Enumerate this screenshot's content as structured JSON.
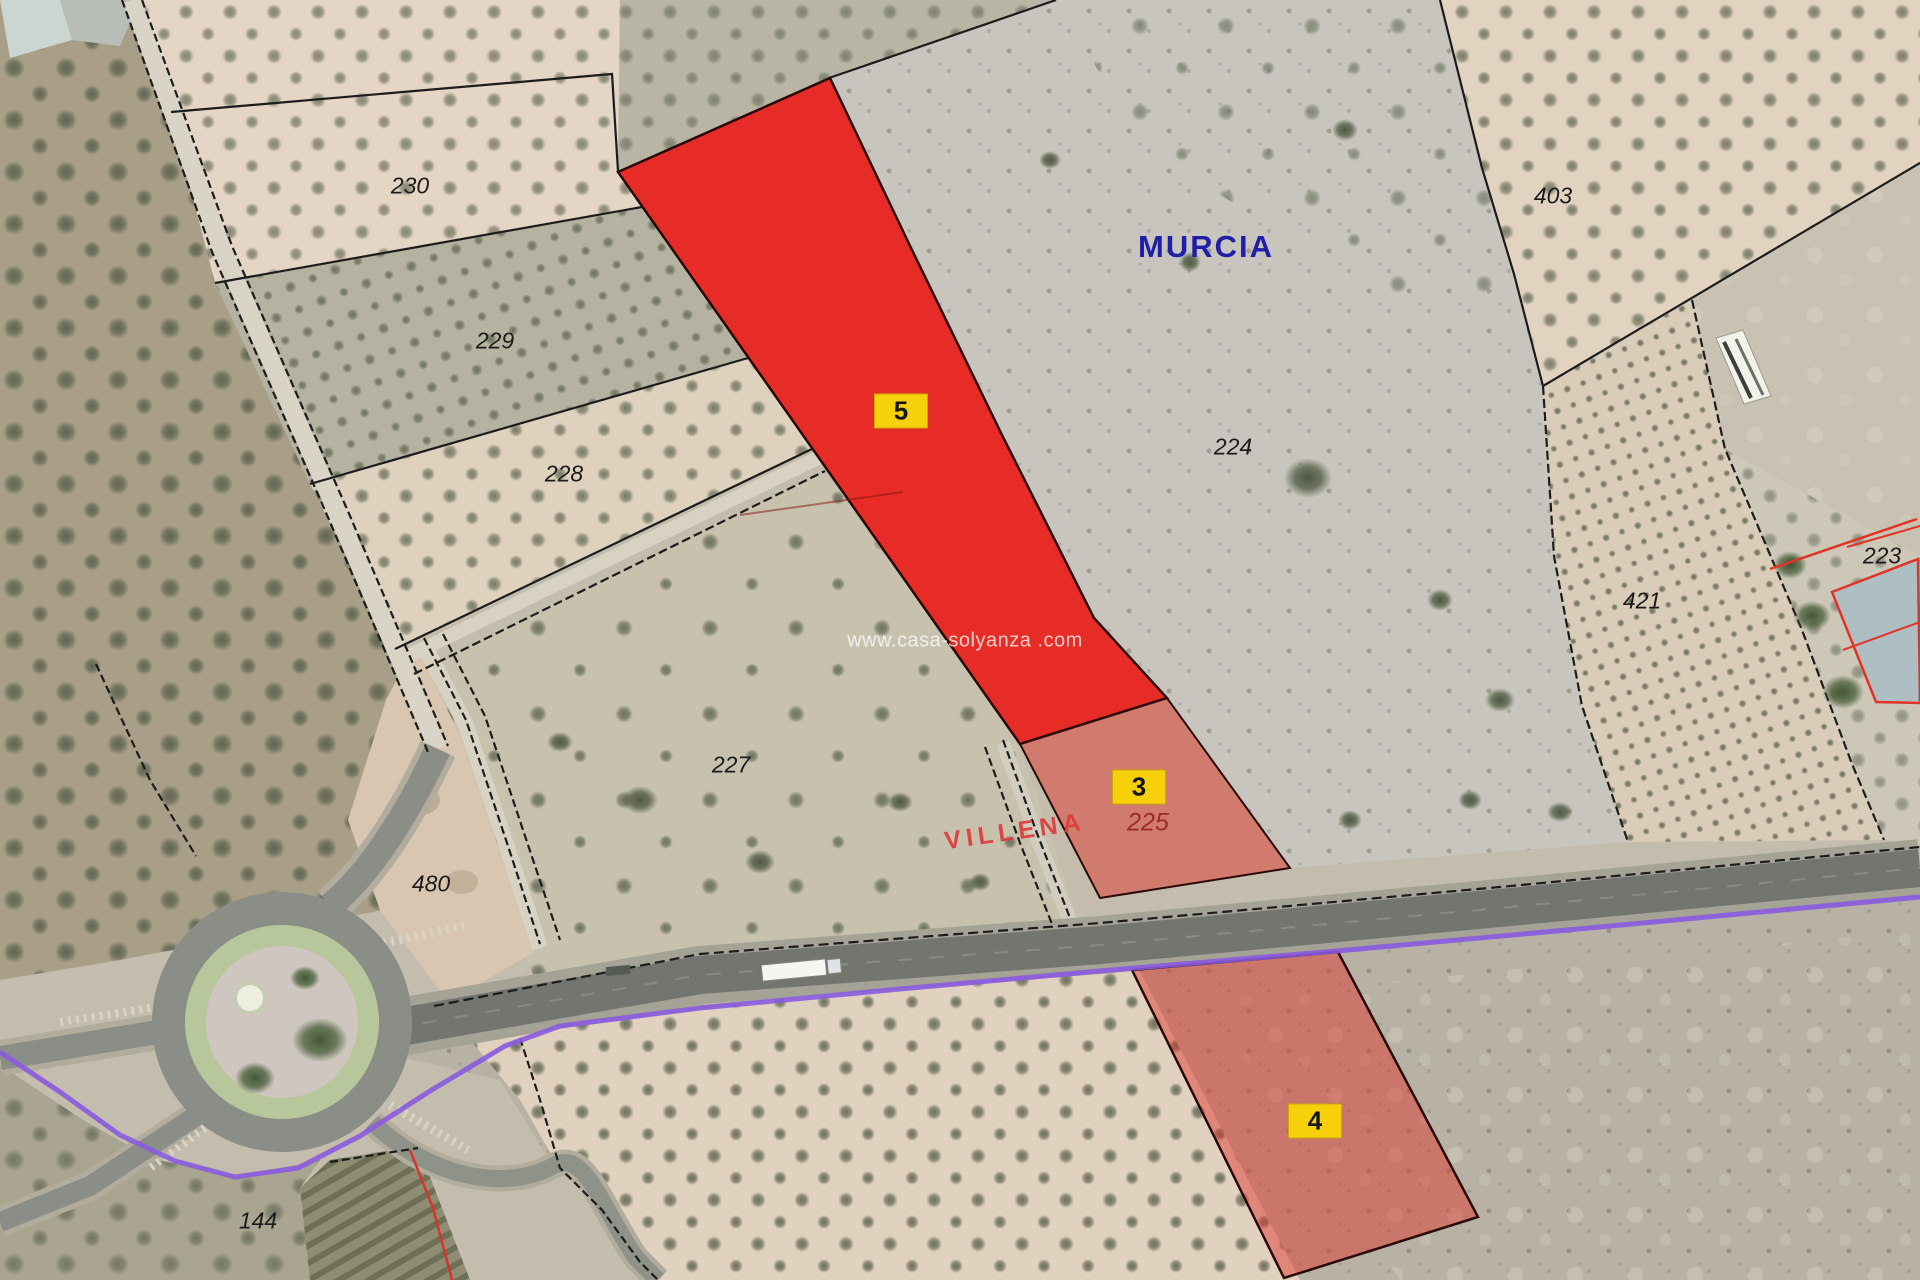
{
  "map": {
    "watermark": "www.casa-solyanza .com",
    "municipality_labels": [
      {
        "text": "MURCIA",
        "color": "#1f1fa8"
      },
      {
        "text": "VILLENA",
        "color": "#dc3c3c"
      }
    ],
    "parcel_numbers": [
      {
        "text": "230"
      },
      {
        "text": "229"
      },
      {
        "text": "228"
      },
      {
        "text": "227"
      },
      {
        "text": "480"
      },
      {
        "text": "144"
      },
      {
        "text": "224"
      },
      {
        "text": "403"
      },
      {
        "text": "421"
      },
      {
        "text": "223"
      },
      {
        "text": "225"
      }
    ],
    "plot_badges": [
      {
        "text": "5"
      },
      {
        "text": "3"
      },
      {
        "text": "4"
      }
    ],
    "colors": {
      "highlight_solid": "#e9211d",
      "highlight_translucent": "rgba(226,44,38,0.45)",
      "badge_yellow": "#f6d10b",
      "boundary_purple": "#8a5ae0",
      "cadastral_red": "#e23327",
      "boundary_black": "#1c1c1c"
    }
  }
}
